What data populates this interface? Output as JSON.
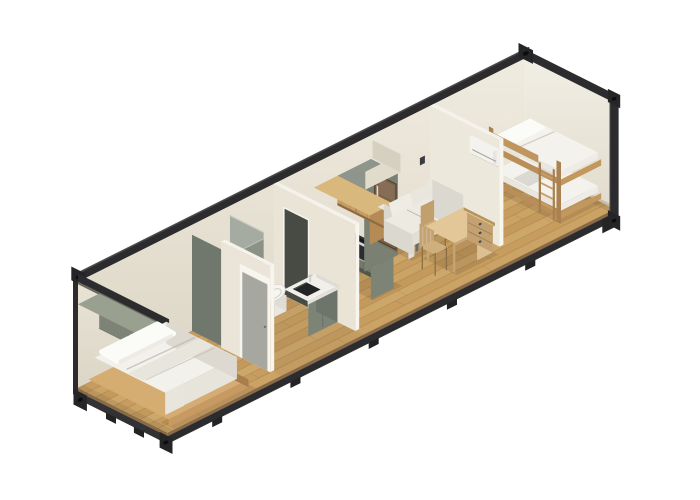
{
  "scene": {
    "title": "3D isometric cutaway render of a shipping container tiny home",
    "description": "Isometric dollhouse-style render of a 40ft container home with bedroom, bathroom, kitchen, living area and kids bunk room inside a dark steel container frame, on a white background.",
    "view": "isometric-cutaway",
    "structure": "shipping-container",
    "rooms": [
      {
        "id": "bedroom",
        "label": "Bedroom",
        "items": [
          "overhead-cabinet",
          "double-bed"
        ]
      },
      {
        "id": "bathroom",
        "label": "Bathroom",
        "items": [
          "shower",
          "partition-wall-kitchen",
          "toilet",
          "vanity-sink",
          "partition-wall-bedroom",
          "bathroom-door"
        ]
      },
      {
        "id": "kitchen",
        "label": "Kitchen",
        "items": [
          "base-cabinets",
          "cooktop",
          "oven",
          "tall-fridge-cabinet",
          "soffit",
          "upper-cabinets"
        ]
      },
      {
        "id": "living-area",
        "label": "Living area",
        "items": [
          "wall-switch",
          "sofa",
          "side-chair",
          "desk",
          "drawer-pedestal",
          "desk-chair"
        ]
      },
      {
        "id": "kids-room",
        "label": "Kids room",
        "items": [
          "bunk-bed",
          "bunk-ladder",
          "partition-wall-living",
          "air-conditioner"
        ]
      }
    ],
    "palette": {
      "background": "#ffffff",
      "frame": {
        "dark": "#2c2c2e",
        "darker": "#1f1f21",
        "top": "#4b4b4e",
        "casting": "#252527",
        "hole": "#0d0d0e",
        "foot": "#232325"
      },
      "walls": {
        "back_top": "#efebdf",
        "back_bottom": "#dcd5c5",
        "right_top": "#f1eee4",
        "right_bottom": "#e1dccd",
        "left_top": "#e8e3d5",
        "left_bottom": "#d6d0c0",
        "partition": "#eae5d8",
        "partition2": "#e9e4d6",
        "partition3": "#ece8db",
        "partition_top": "#f4f2ea",
        "partition_edge": "#f7f5ee",
        "door_panel": "#a6a8a0",
        "opening_dark": "#474b44",
        "base_shadow": "rgba(110,92,62,0.22)"
      },
      "floor": {
        "base": "#c89f63",
        "plank_a": "#c49a5d",
        "plank_b": "#cda668",
        "plank_c": "#bf9357",
        "plank_d": "#d2ad71",
        "seam": "rgba(110,80,45,0.30)",
        "edge": "#8a6a44",
        "bath_tint": "rgba(120,100,70,0.10)",
        "shadow": "rgba(85,65,40,0.16)"
      },
      "sage": {
        "front": "#7d8477",
        "side": "#6d746a",
        "top": "#99a090",
        "end": "#8a9083",
        "kitchen_front": "#717868",
        "kitchen_end": "#7d8476",
        "kick": "#50564c",
        "column": "#6d746a",
        "column_end": "#7a8173",
        "column_top": "#8f958a"
      },
      "wood": {
        "face": "#c79e66",
        "top": "#d9b87e",
        "side": "#a87f4e",
        "end": "#b68a54",
        "dark": "#8d6c42",
        "grain": "rgba(120,82,40,0.28)",
        "bed_front": "#c79a63",
        "bed_side": "#a87e4c",
        "bed_top": "#d5ad72"
      },
      "counter": {
        "top": "#3b3d3c",
        "edge": "#2c2e2d",
        "cooktop": "#191a1c",
        "burner": "rgba(95,98,102,0.85)"
      },
      "oven": {
        "frame": "#a8abac",
        "glass": "#2b2c2f",
        "handle": "#d6d8d9"
      },
      "fridge": {
        "door": "#7b6148",
        "frame": "#55422f",
        "handle": "#d9dbdc",
        "sheen": "rgba(255,255,255,0.08)"
      },
      "soffit": {
        "front": "#e1dbcb",
        "side": "#d6d0c0"
      },
      "shower": {
        "left": "#70776d",
        "right": "#a6aba2",
        "front": "#8b9187",
        "tray": "rgba(130,135,128,0.25)"
      },
      "bath": {
        "white": "#f6f5f1",
        "white_dim": "#e9e7e0",
        "white_side": "#dedcd4",
        "counter": "#f1efe9",
        "counter_edge": "#e2e0d8",
        "sink": "#232426",
        "faucet": "#c9cccd",
        "rim": "#d8d6ce"
      },
      "textile": {
        "duvet_top": "#f3f1eb",
        "duvet_front": "#e7e4dc",
        "duvet_side": "#ddd9d0",
        "fold": "rgba(190,186,176,0.85)",
        "pillow": "#fbfbf8",
        "pillow_side": "#ece9e1",
        "throw": "#e8e5dd",
        "blanket": "#dbd9d4",
        "mattress_top": "#f4f2ec",
        "mattress_side": "#e9e6df",
        "mattress_end": "#efece5"
      },
      "sofa": {
        "seat_top": "#edeae2",
        "front": "#e2dfd7",
        "side": "#d6d3ca",
        "arm_top": "#eae7df",
        "arm_front": "#e5e2da",
        "arm_side": "#dbd8cf",
        "cushion": "#efece4",
        "cushion2": "#e9e6de",
        "leg": "#6b6b6d"
      },
      "desk": {
        "top": "#e4c798",
        "edge": "#c9a877",
        "side": "#b5945e",
        "leg": "#c6a575",
        "pedestal_front": "#dcc094",
        "pedestal_side": "#c3a170",
        "knob": "#45464a"
      },
      "chair": {
        "wood": "#c4a372",
        "seat": "#d0af7e",
        "dark": "#8a6f46",
        "seat2": "#cdac7a",
        "back2": "#c1a06e"
      },
      "bunk": {
        "side": "#b98e58",
        "end": "#c2985f",
        "post": "#aa8150",
        "rail": "#c0955e",
        "ladder": "#a87f4e",
        "rung": "#c89c64"
      },
      "ac": {
        "body": "#f3f2ee",
        "cap": "#e7e5df",
        "vent": "rgba(150,148,140,0.9)",
        "shadow": "rgba(0,0,0,0.10)"
      },
      "misc": {
        "switch": "#3a3b3e"
      }
    }
  }
}
